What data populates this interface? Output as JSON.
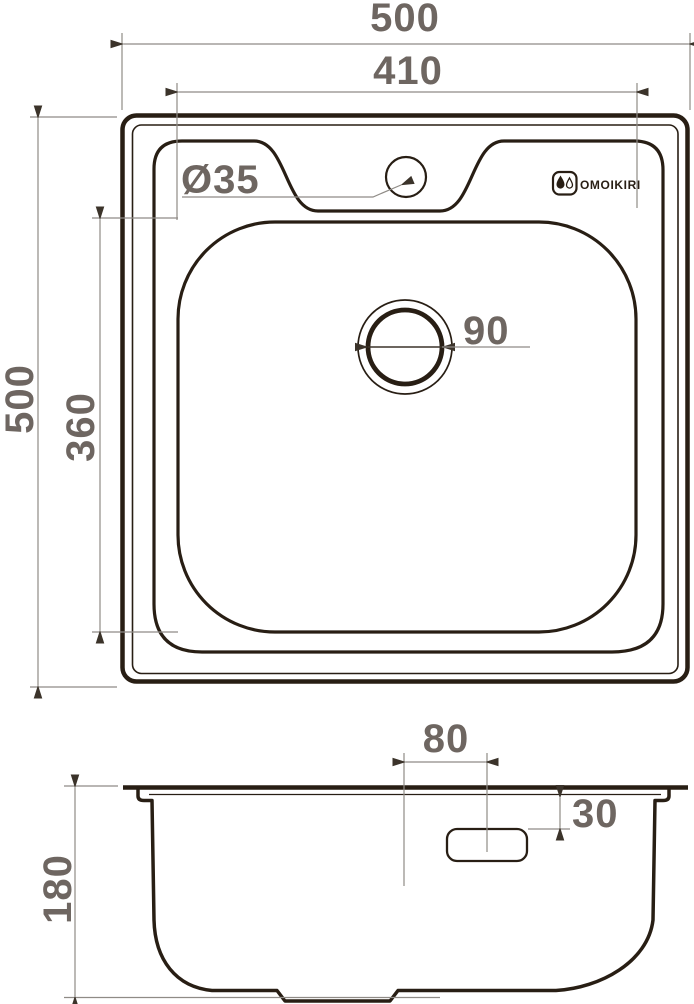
{
  "colors": {
    "background": "#ffffff",
    "ink": "#281e14",
    "dim_line": "#8f8b86",
    "dim_text": "#6e6661",
    "arrow": "#3b332a"
  },
  "top_view": {
    "dims": {
      "overall_width": "500",
      "overall_height": "500",
      "bowl_width": "410",
      "bowl_height": "360",
      "faucet_hole_diameter": "Ø35",
      "drain_diameter": "90"
    },
    "brand": {
      "name": "OMOIKIRI",
      "icon": "double-droplet-icon"
    }
  },
  "side_view": {
    "dims": {
      "bowl_depth": "180",
      "overflow_center_offset": "80",
      "overflow_top_offset": "30"
    }
  }
}
